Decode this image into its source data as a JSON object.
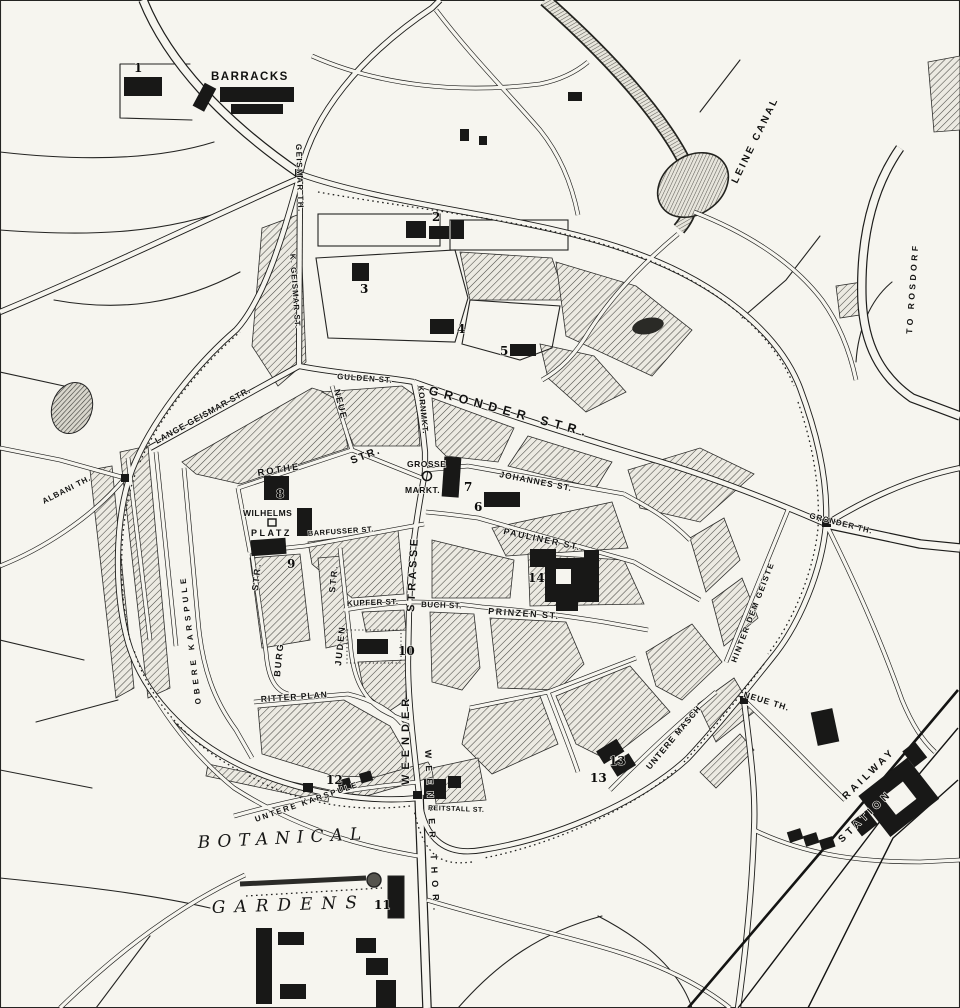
{
  "map": {
    "colors": {
      "paper": "#f6f5ef",
      "ink": "#1c1c1b"
    },
    "labels": {
      "barracks": "BARRACKS",
      "leine_canal": "LEINE CANAL",
      "to_rosdorf": "TO ROSDORF",
      "geismar_th": "GEISMAR TH.",
      "k_geismar_st": "K. GEISMAR ST.",
      "lange_geismar_str": "LANGE GEISMAR STR.",
      "gulden_st": "GULDEN ST.",
      "gronder_str": "GRONDER STR.",
      "kornmkt": "KORNMKT.",
      "grosse": "GROSSE",
      "markt": "MARKT.",
      "johannes_st": "JOHANNES ST.",
      "rothe": "ROTHE",
      "neue": "NEUE",
      "neue_str": "STR.",
      "wilhelms": "WILHELMS",
      "platz": "PLATZ",
      "barfusser_st": "BARFUSSER ST.",
      "weender": "WEENDER",
      "strasse": "STRASSE",
      "juden": "JUDEN",
      "juden_str": "STR.",
      "burg": "BURG",
      "burg_str": "STR.",
      "kupfer_st": "KUPFER ST.",
      "buch_st": "BUCH ST.",
      "prinzen_st": "PRINZEN ST.",
      "pauliner_st": "PAULINER ST.",
      "ritter_plan": "RITTER PLAN",
      "obere_karspule": "OBERE KARSPULE",
      "untere_karspule": "UNTERE KARSPULE",
      "untere_masch": "UNTERE MASCH",
      "hinter_dem_geiste": "HINTER DEM GEISTE",
      "gronder_th": "GRONDER TH.",
      "albani_th": "ALBANI TH.",
      "neue_th": "NEUE TH.",
      "weender_thor": "WEENDER THOR.",
      "botanical": "BOTANICAL",
      "gardens": "GARDENS",
      "railway": "RAILWAY",
      "station": "STATION",
      "reitstall_st": "REITSTALL ST."
    },
    "numbers": {
      "n1": "1",
      "n2": "2",
      "n3": "3",
      "n4": "4",
      "n5": "5",
      "n6": "6",
      "n7": "7",
      "n8": "8",
      "n9": "9",
      "n10": "10",
      "n11": "11",
      "n12": "12",
      "n13a": "13",
      "n13b": "13",
      "n14": "14"
    }
  }
}
